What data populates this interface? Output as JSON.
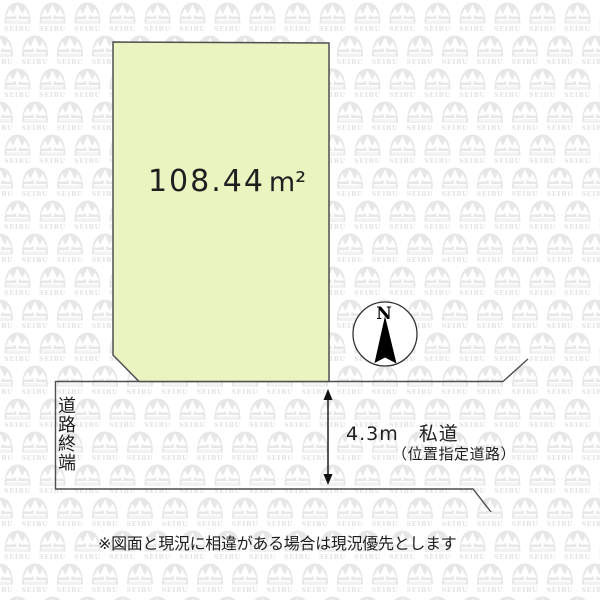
{
  "colors": {
    "plot_fill": "#e9f4c1",
    "line": "#4f4f4f",
    "text": "#1f1f1f",
    "watermark": "#e7e7e7"
  },
  "plot": {
    "area_value": "108.44",
    "area_unit": "m²"
  },
  "compass": {
    "north_label": "N"
  },
  "road": {
    "dead_end_label": "道路終端",
    "width_label": "4.3m　私道",
    "type_label": "（位置指定道路）"
  },
  "footer": {
    "disclaimer": "※図面と現況に相違がある場合は現況優先とします"
  },
  "watermark": {
    "brand": "SEIBU"
  }
}
